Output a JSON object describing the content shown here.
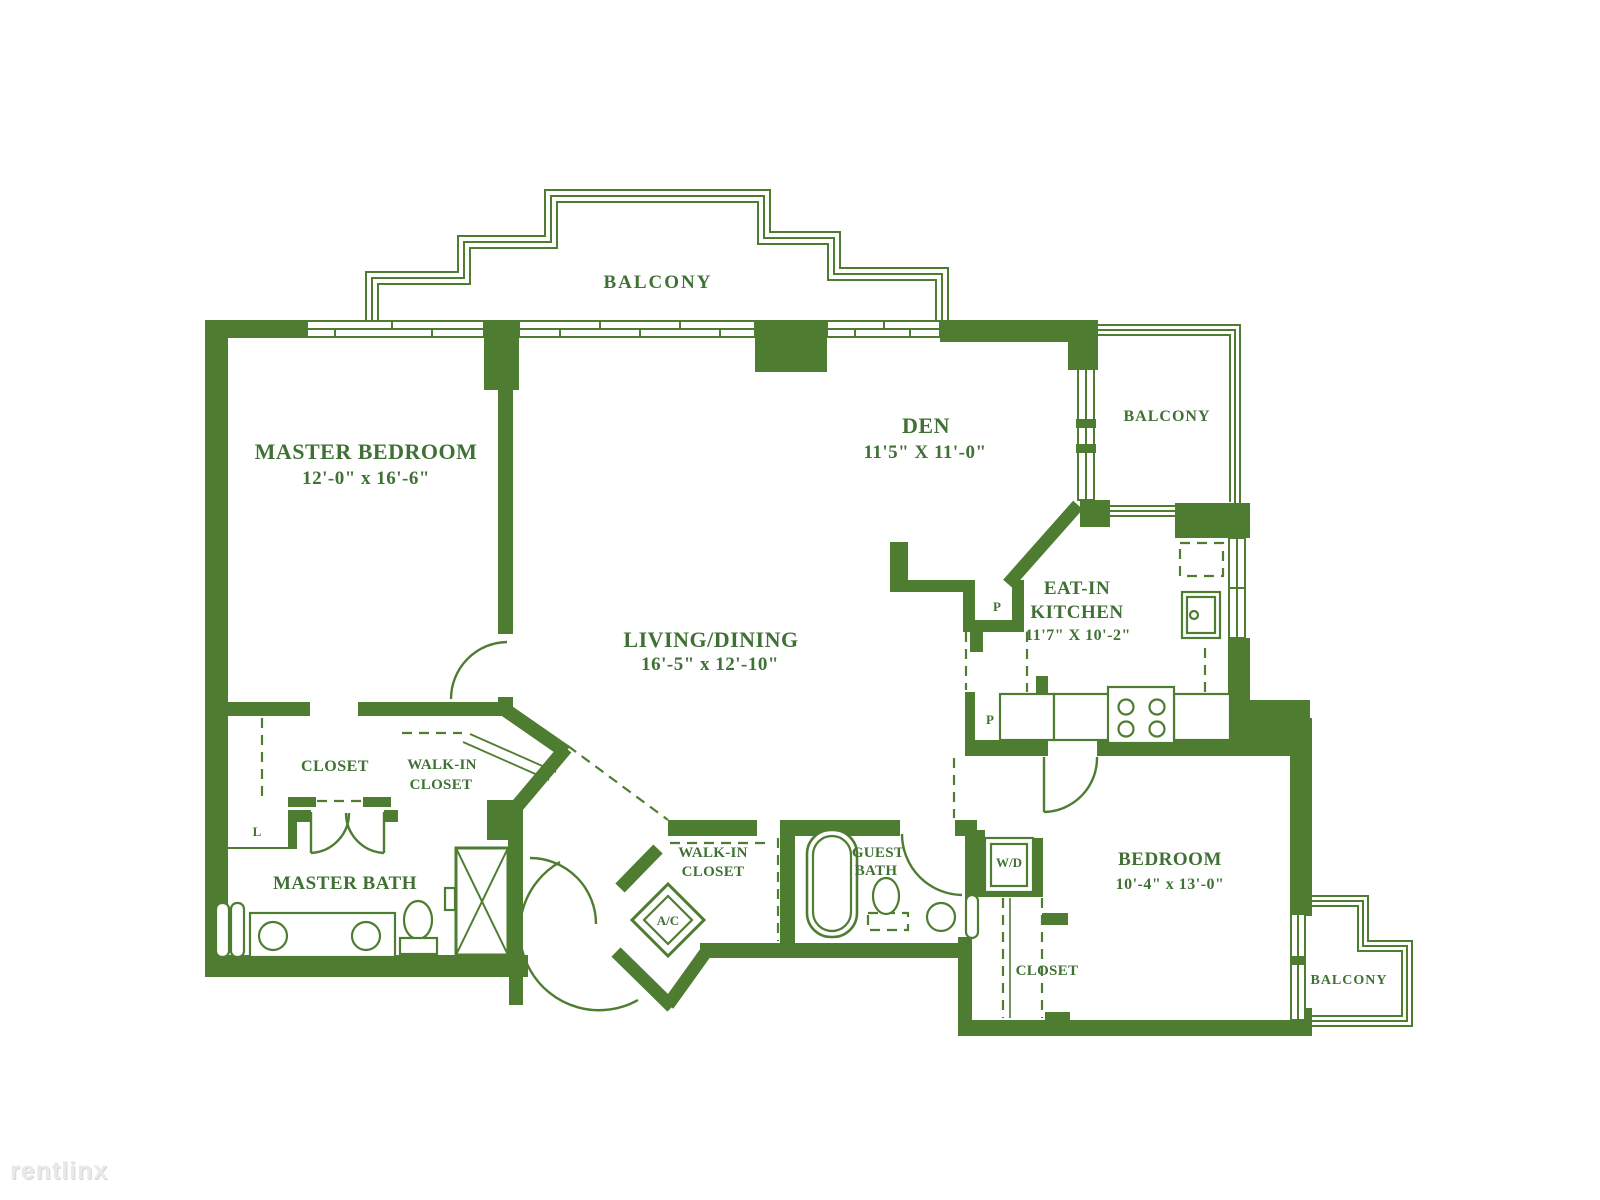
{
  "colors": {
    "wall_green": "#4e7c31",
    "text_green": "#3f7034",
    "background": "#ffffff",
    "watermark_gray": "#e9e9e9"
  },
  "watermark": {
    "logo": "rentlinx"
  },
  "labels": {
    "balcony_top": "BALCONY",
    "balcony_right": "BALCONY",
    "balcony_bottom_right": "BALCONY",
    "master_bedroom_name": "MASTER BEDROOM",
    "master_bedroom_dims": "12'-0\" x 16'-6\"",
    "den_name": "DEN",
    "den_dims": "11'5\" X 11'-0\"",
    "living_name": "LIVING/DINING",
    "living_dims": "16'-5\" x 12'-10\"",
    "kitchen_line1": "EAT-IN",
    "kitchen_line2": "KITCHEN",
    "kitchen_dims": "11'7\" X 10'-2\"",
    "bedroom_name": "BEDROOM",
    "bedroom_dims": "10'-4\" x 13'-0\"",
    "master_bath": "MASTER BATH",
    "guest_bath_line1": "GUEST",
    "guest_bath_line2": "BATH",
    "closet_master": "CLOSET",
    "closet_bedroom": "CLOSET",
    "wic_master_line1": "WALK-IN",
    "wic_master_line2": "CLOSET",
    "wic_hall_line1": "WALK-IN",
    "wic_hall_line2": "CLOSET",
    "linen": "L",
    "ac_unit": "A/C",
    "washer_dryer": "W/D",
    "pantry_upper": "P",
    "pantry_lower": "P"
  }
}
